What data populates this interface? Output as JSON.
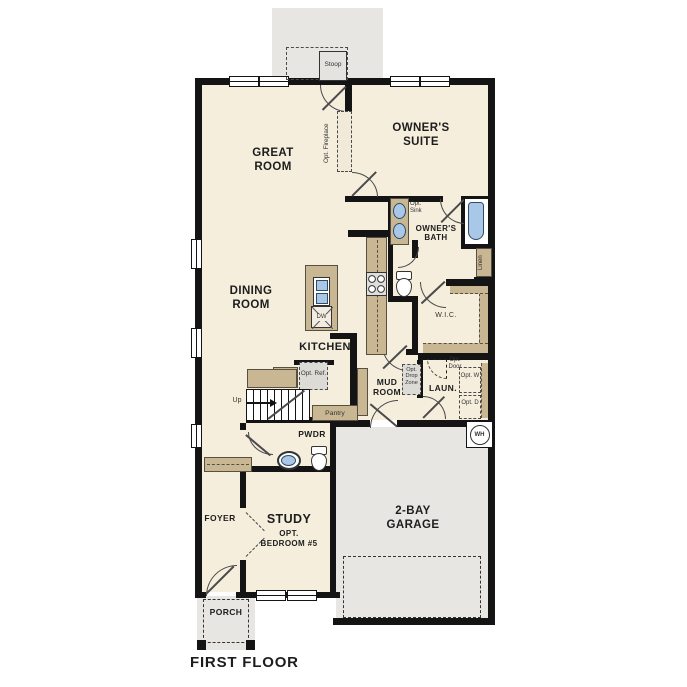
{
  "title": "FIRST FLOOR",
  "labels": {
    "great_room": "GREAT ROOM",
    "owners_suite": "OWNER'S SUITE",
    "owners_bath": "OWNER'S BATH",
    "dining_room": "DINING ROOM",
    "kitchen": "KITCHEN",
    "wic": "W.I.C.",
    "mud_room": "MUD ROOM",
    "laundry": "LAUN.",
    "powder": "PWDR",
    "study": "STUDY",
    "study_opt": "OPT.",
    "study_opt2": "BEDROOM #5",
    "foyer": "FOYER",
    "garage": "2-BAY GARAGE",
    "porch": "PORCH",
    "stoop": "Stoop",
    "pantry": "Pantry",
    "linen": "Linen",
    "first_floor": "FIRST FLOOR"
  },
  "annotations": {
    "opt_fireplace": "Opt. Fireplace",
    "opt_sink": "Opt. Sink",
    "opt_ref": "Opt. Ref.",
    "opt_drop_zone": "Opt. Drop Zone",
    "opt_door": "Opt. Door",
    "opt_washer": "Opt. W",
    "opt_dryer": "Opt. D",
    "water_heater": "WH",
    "stairs_up": "Up",
    "dishwasher": "DW"
  },
  "colors": {
    "wall": "#141414",
    "floor": "#f5eedd",
    "garage_gray": "#e7e6e2",
    "counter_tan": "#c9b793",
    "fixture_blue": "#a9c7e7",
    "optional_fill": "#dcdbd5"
  }
}
